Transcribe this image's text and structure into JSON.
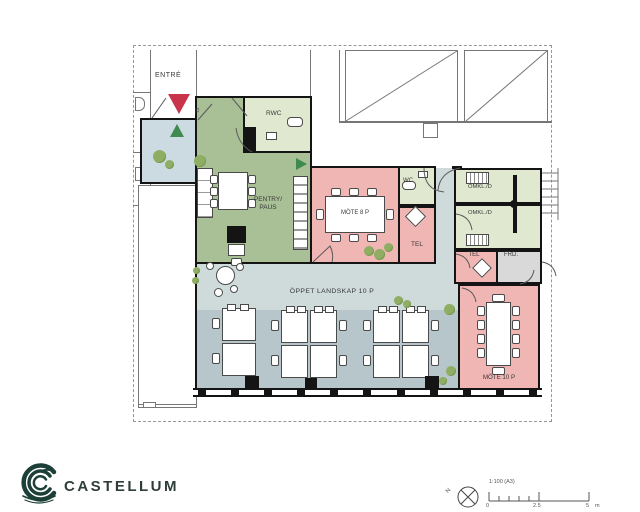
{
  "plan": {
    "labels": {
      "entre": "ENTRÉ",
      "el": "EL",
      "rwc": "RWC",
      "pentry_line1": "PENTRY/",
      "pentry_line2": "PAUS",
      "mote8": "MÖTE 8 P",
      "wc": "WC",
      "tel1": "TEL",
      "omkl1": "OMKL./D",
      "omkl2": "OMKL./D",
      "tel2": "TEL",
      "frd": "FRD.",
      "oppet": "ÖPPET LANDSKAP 10 P",
      "mote10": "MÖTE 10 P"
    },
    "colors": {
      "meeting_pink": "#f0b6b3",
      "pentry_green": "#a9bf96",
      "wet_room_green": "#e1e8d0",
      "open_plan_light": "#cfdadb",
      "open_plan_dark": "#b6c6ca",
      "entry_hall_blue": "#ccdbe1",
      "storage_grey": "#d9d9d9",
      "tree_green": "#8fae63",
      "wall_black": "#141414",
      "entry_marker_red": "#c8354a",
      "exit_marker_green": "#3f8a4f",
      "brand_green": "#1c4037"
    }
  },
  "footer": {
    "brand": "CASTELLUM"
  },
  "titleblock": {
    "scale_text": "1:100  (A3)",
    "north": "N",
    "ticks": [
      "0",
      "2.5",
      "5",
      "m"
    ]
  }
}
